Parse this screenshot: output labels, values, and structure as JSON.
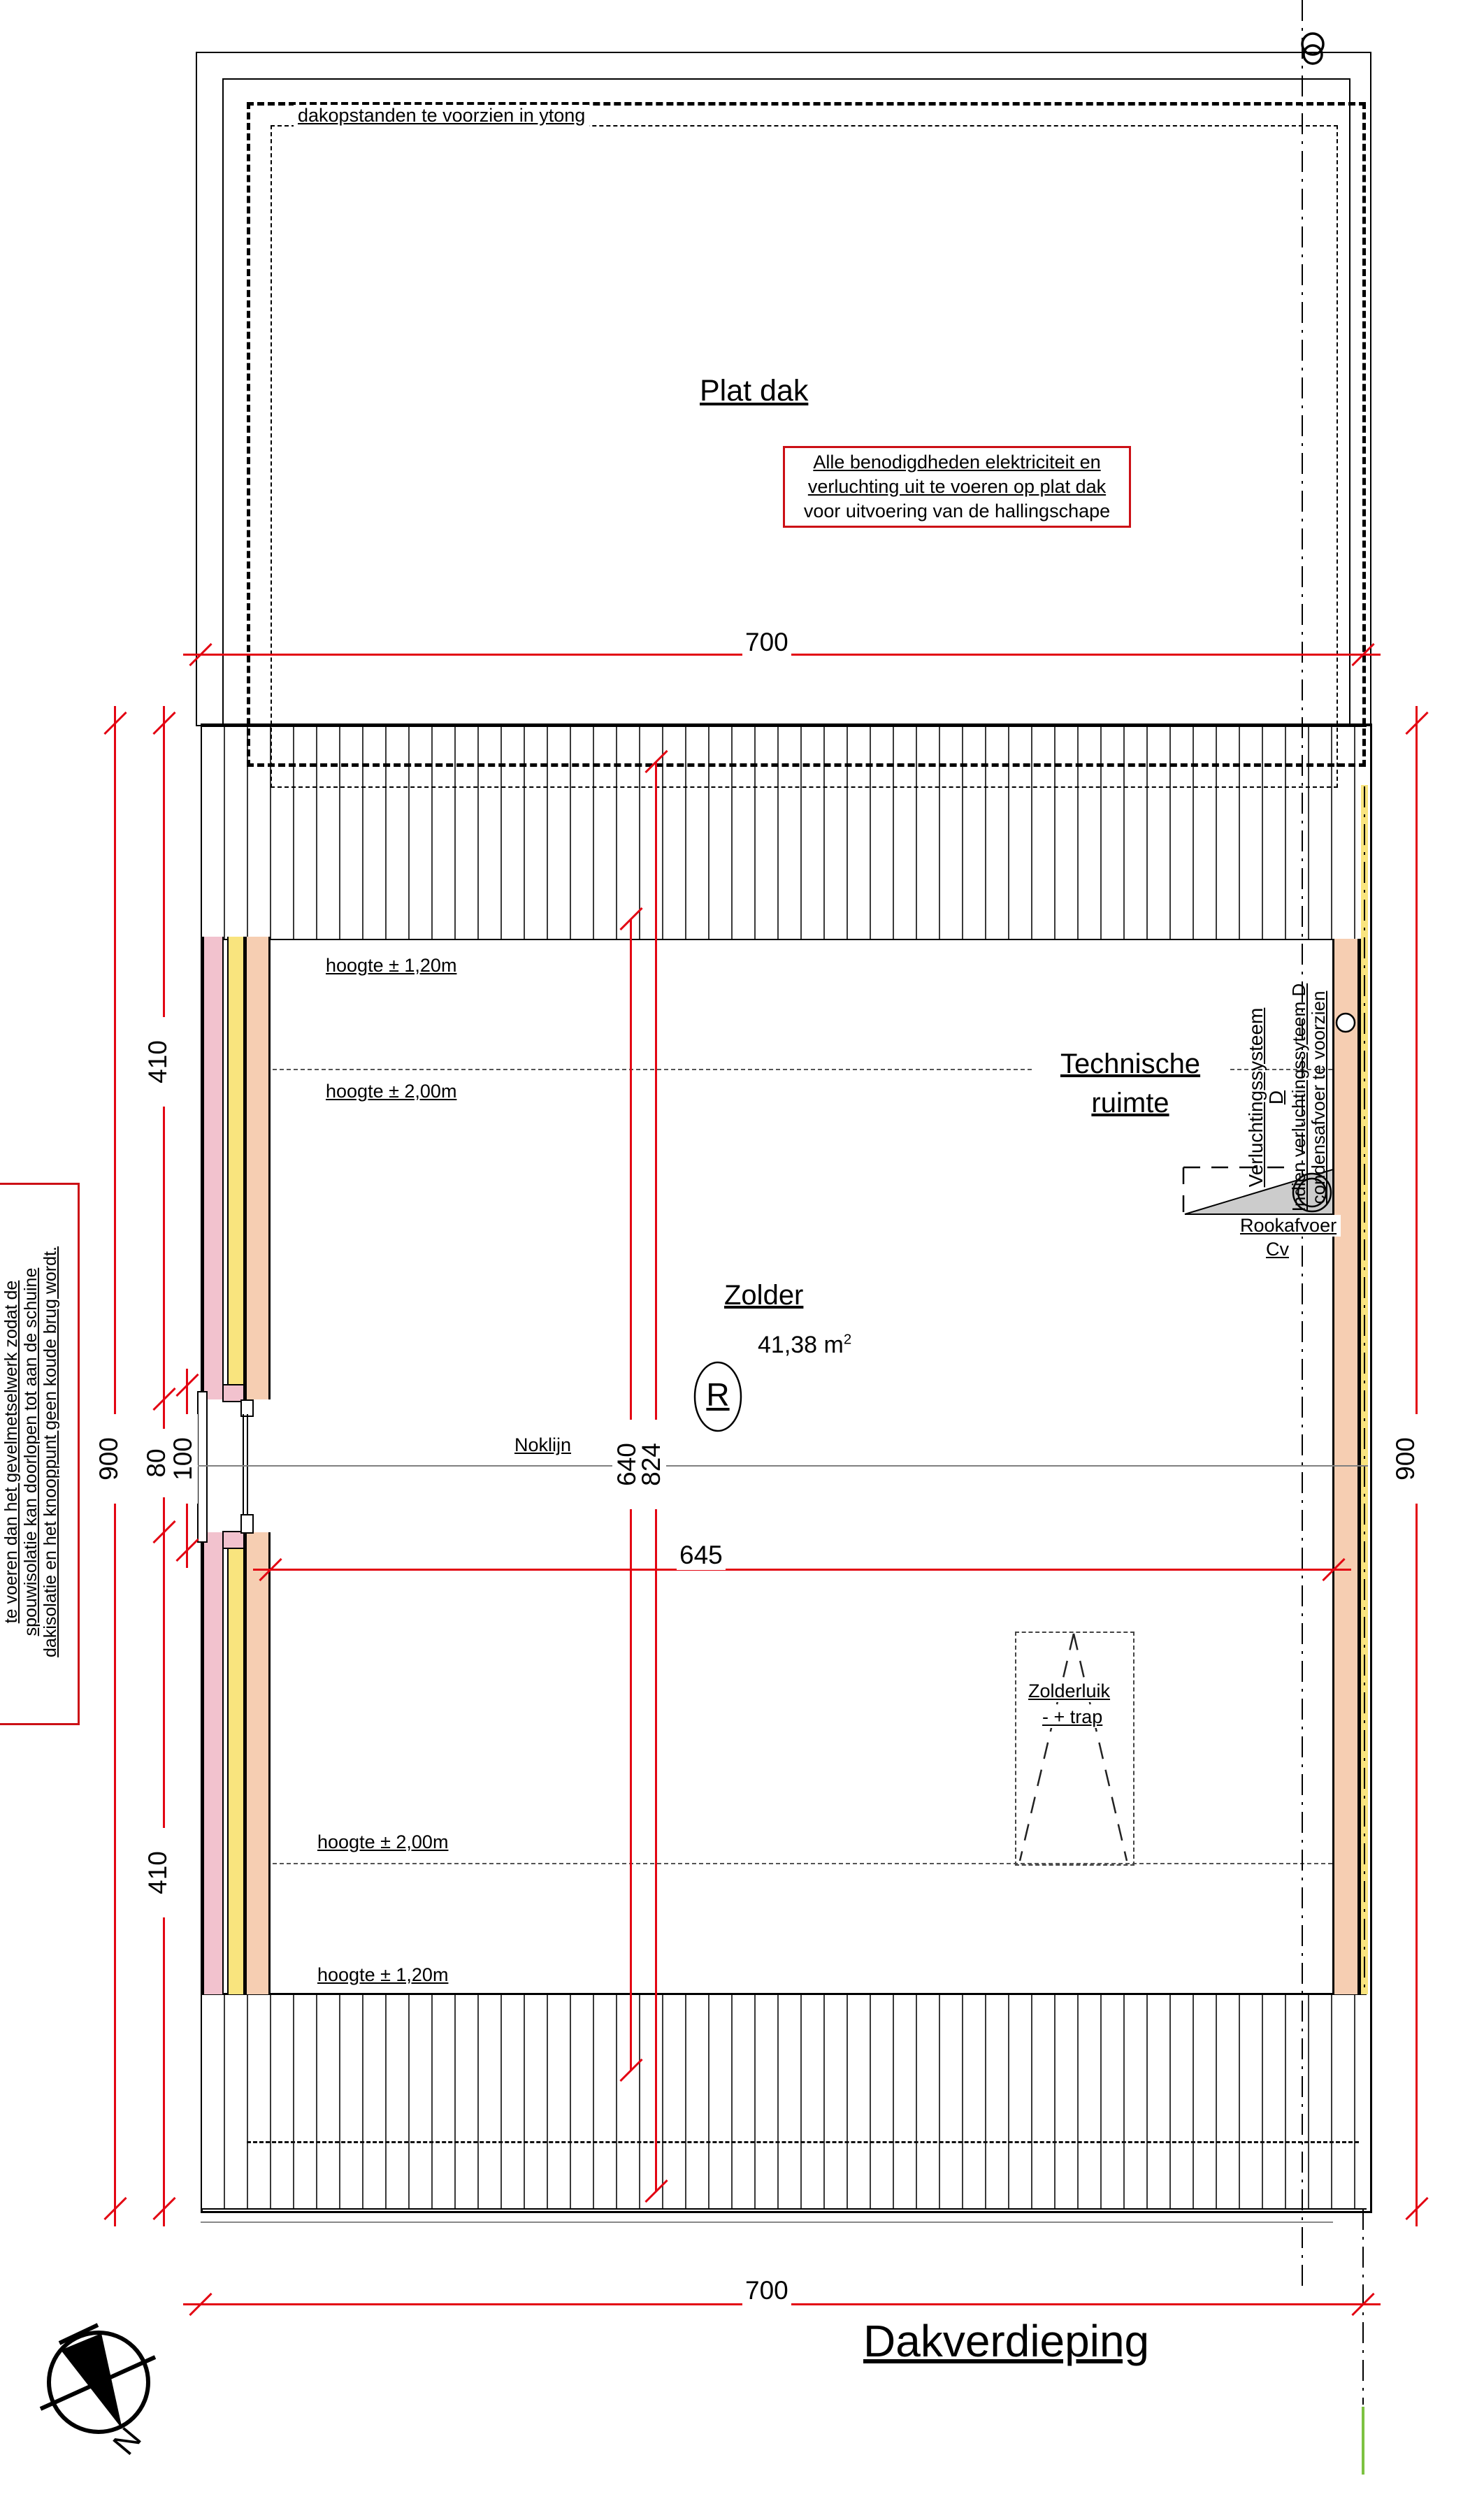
{
  "title": "Dakverdieping",
  "compass": {
    "north_label": "N"
  },
  "plat_dak": {
    "label": "Plat dak",
    "edge_note": "dakopstanden te voorzien in ytong",
    "warning_box": {
      "line1": "Alle benodigdheden elektriciteit en",
      "line2": "verluchting uit te voeren op plat dak",
      "line3": "voor uitvoering van de hallingschape",
      "border_color": "#cc1016"
    }
  },
  "rooms": {
    "zolder": {
      "name": "Zolder",
      "area_value": "41,38 m",
      "area_sup": "2",
      "tag": "R"
    },
    "technische": {
      "line1": "Technische",
      "line2": "ruimte"
    }
  },
  "labels": {
    "hoogte_120": "hoogte ± 1,20m",
    "hoogte_200": "hoogte ± 2,00m",
    "noklijn": "Noklijn",
    "zolderluik_line1": "Zolderluik",
    "zolderluik_line2": "- + trap",
    "rookafvoer": "Rookafvoer",
    "cv": "Cv",
    "verluchting_line1": "Verluchtingssysteem",
    "verluchting_line2": "D",
    "indien_line1": "Indien verluchtingssyteem D",
    "indien_line2": "condensafvoer te voorzien"
  },
  "side_note": {
    "line1": "te voeren dan het gevelmetselwerk zodat de",
    "line2": "spouwisolatie kan doorlopen tot aan de schuine",
    "line3": "dakisolatie en het knooppunt geen koude brug wordt."
  },
  "dimensions": {
    "top_width": "700",
    "bottom_width": "700",
    "left_total": "900",
    "right_total": "900",
    "left_upper": "410",
    "left_opening": "80",
    "left_opening_full": "100",
    "left_lower": "410",
    "ridge_left": "640",
    "ridge_right": "824",
    "interior_width": "645"
  },
  "colors": {
    "dimension_red": "#e30613",
    "wall_pink": "#f2c2ce",
    "wall_yellow": "#f9e47e",
    "wall_salmon": "#f6ceb2",
    "boundary_green": "#7dc242",
    "triangle_gray": "#cccccc"
  }
}
